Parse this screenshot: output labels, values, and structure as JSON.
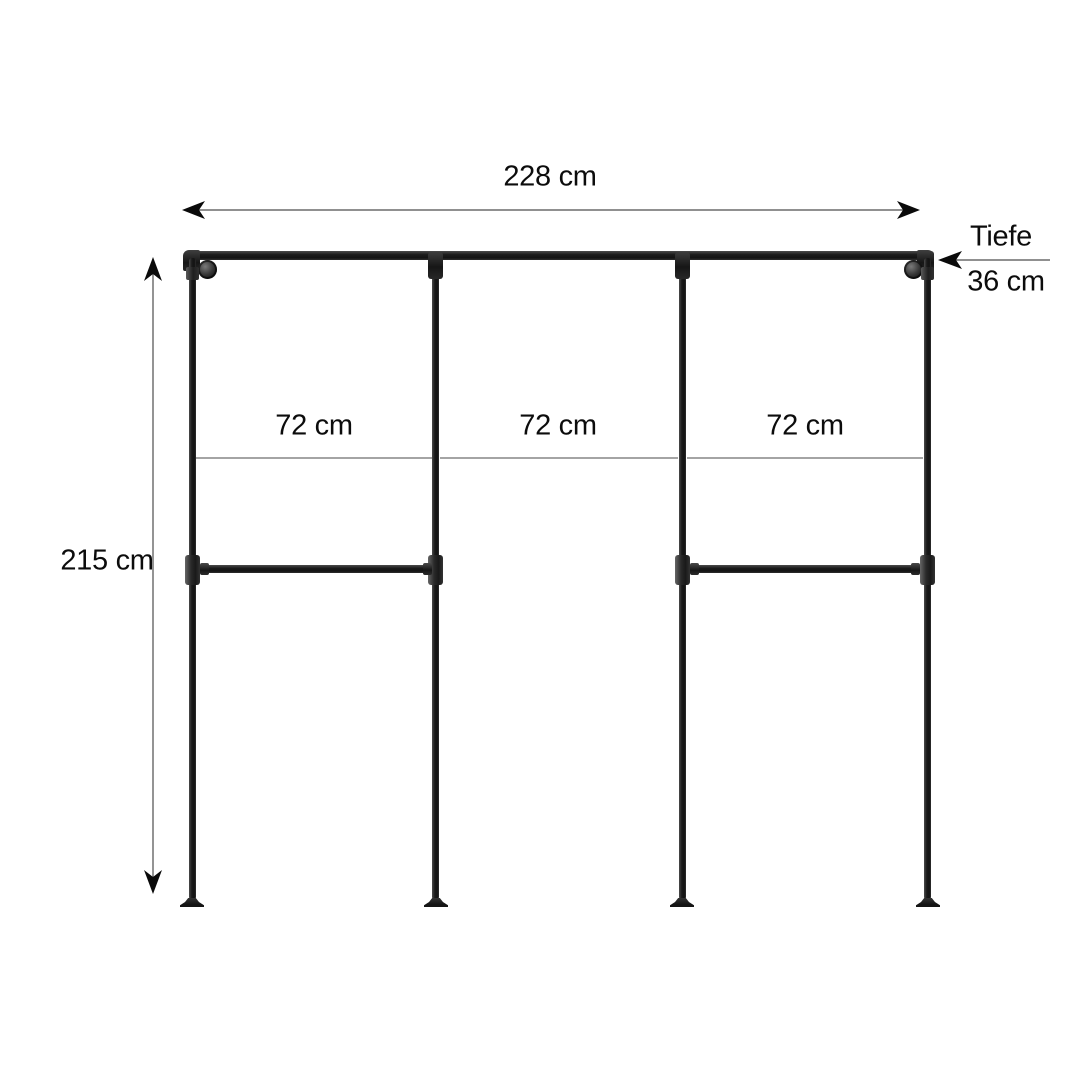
{
  "diagram": {
    "description": "Industrial pipe clothing rack dimension drawing, three sections",
    "labels": {
      "total_width": "228 cm",
      "total_height": "215 cm",
      "depth_name": "Tiefe",
      "depth_value": "36 cm"
    },
    "sections": [
      "72 cm",
      "72 cm",
      "72 cm"
    ],
    "colors": {
      "pipe": "#1e1e1e",
      "fitting-highlight": "#6f6f6f",
      "dim-line": "#4d4d4d",
      "section-line": "#858585",
      "label-text": "#0c0c0c",
      "background": "#ffffff"
    }
  }
}
